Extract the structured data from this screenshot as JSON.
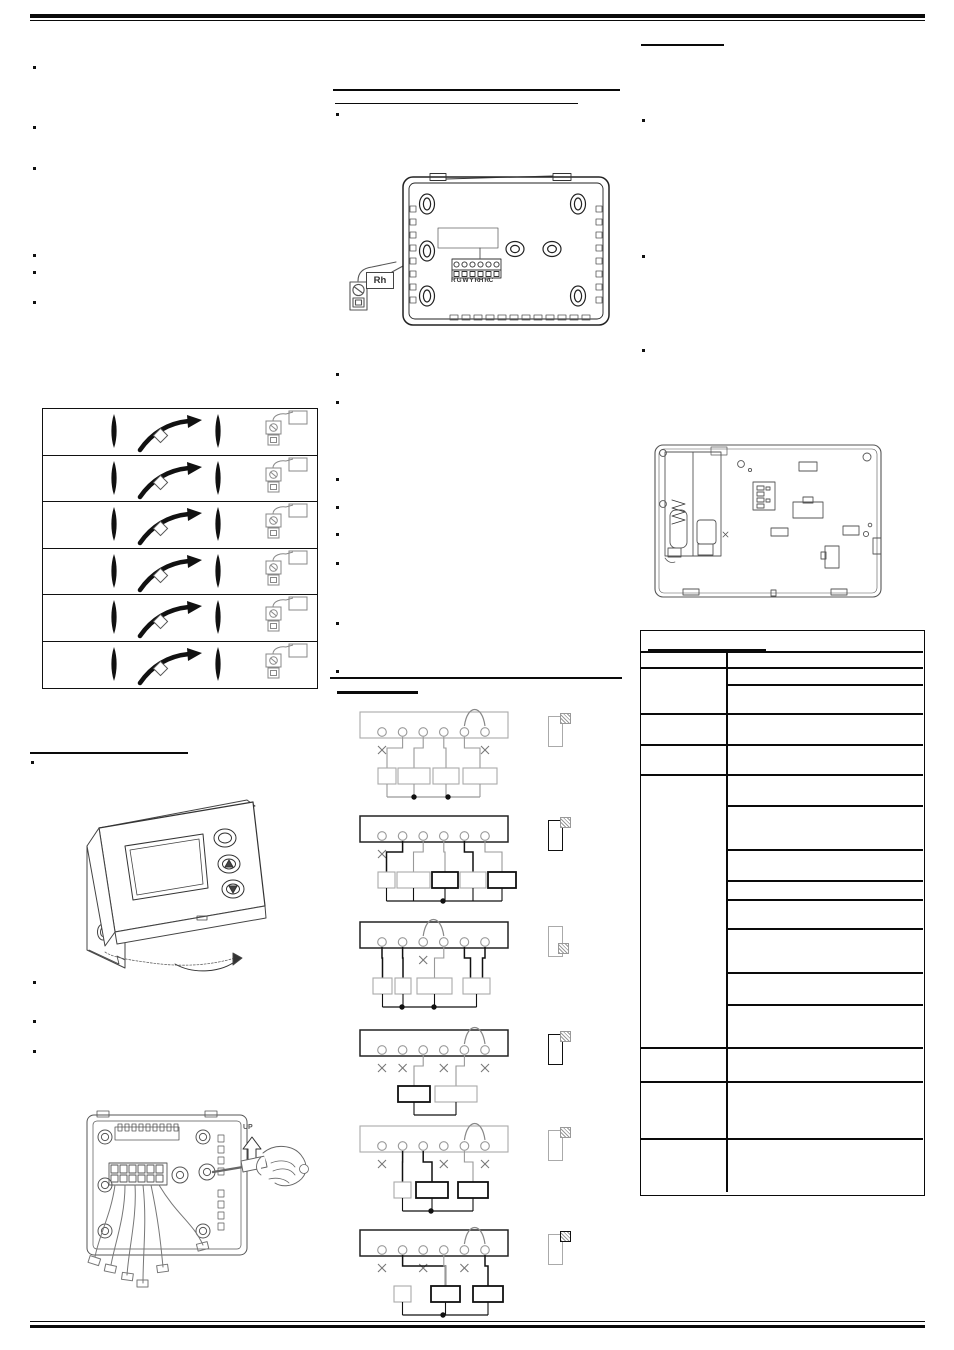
{
  "page": {
    "background": "#ffffff",
    "ink": "#1a1a1a",
    "gray": "#9a9a9a"
  },
  "labels": {
    "rh_terminal": "Rh",
    "terminal_row": "R G W Y RH RC",
    "up": "UP"
  },
  "figures": {
    "dip_setting_table": {
      "row_count": 6,
      "row_icons": [
        "toggle-marker",
        "rotate-gesture-arrow",
        "toggle-marker",
        "rh-screw-terminal"
      ]
    },
    "wiring_diagrams": [
      {
        "y": 712,
        "strip": "gray",
        "jumper": [
          5,
          6
        ],
        "crossed": [
          1,
          6
        ],
        "connections": [
          [
            2,
            1,
            "g",
            0
          ],
          [
            3,
            2,
            "g",
            0
          ],
          [
            4,
            3,
            "g",
            0
          ],
          [
            5,
            4,
            "g",
            0
          ]
        ],
        "boxes": [
          {
            "x": 378,
            "w": 18,
            "bold": false
          },
          {
            "x": 398,
            "w": 32,
            "bold": false
          },
          {
            "x": 433,
            "w": 26,
            "bold": false
          },
          {
            "x": 463,
            "w": 34,
            "bold": false
          }
        ],
        "dots": [
          414,
          448
        ],
        "bottom": "gray",
        "icon": {
          "bold": false,
          "hatch": "tr",
          "hatch_bold": false
        }
      },
      {
        "y": 816,
        "strip": "black",
        "jumper": null,
        "crossed": [
          1
        ],
        "connections": [
          [
            2,
            1,
            "k",
            0
          ],
          [
            3,
            2,
            "g",
            0
          ],
          [
            4,
            3,
            "g",
            0
          ],
          [
            5,
            4,
            "k",
            0
          ],
          [
            6,
            5,
            "g",
            0
          ]
        ],
        "boxes": [
          {
            "x": 378,
            "w": 17,
            "bold": false
          },
          {
            "x": 397,
            "w": 33,
            "bold": false
          },
          {
            "x": 432,
            "w": 26,
            "bold": true
          },
          {
            "x": 460,
            "w": 26,
            "bold": false
          },
          {
            "x": 488,
            "w": 28,
            "bold": true
          }
        ],
        "dots": [
          443
        ],
        "bottom": "black",
        "icon": {
          "bold": true,
          "hatch": "tr",
          "hatch_bold": false
        }
      },
      {
        "y": 922,
        "strip": "black",
        "jumper": [
          3,
          4
        ],
        "crossed": [
          3
        ],
        "connections": [
          [
            1,
            1,
            "k",
            0
          ],
          [
            2,
            2,
            "k",
            0
          ],
          [
            4,
            3,
            "g",
            0
          ],
          [
            5,
            4,
            "k",
            -6
          ],
          [
            6,
            4,
            "k",
            6
          ]
        ],
        "boxes": [
          {
            "x": 373,
            "w": 19,
            "bold": false
          },
          {
            "x": 395,
            "w": 16,
            "bold": false
          },
          {
            "x": 417,
            "w": 35,
            "bold": false
          },
          {
            "x": 463,
            "w": 27,
            "bold": false
          }
        ],
        "dots": [
          402,
          434
        ],
        "bottom": "black",
        "icon": {
          "bold": false,
          "hatch": "br",
          "hatch_bold": false
        }
      },
      {
        "y": 1030,
        "strip": "black",
        "jumper": [
          5,
          6
        ],
        "crossed": [
          1,
          2,
          4,
          6
        ],
        "connections": [
          [
            3,
            1,
            "g",
            0
          ],
          [
            5,
            2,
            "g",
            0
          ]
        ],
        "boxes": [
          {
            "x": 398,
            "w": 32,
            "bold": true
          },
          {
            "x": 435,
            "w": 42,
            "bold": false
          }
        ],
        "dots": [],
        "bottom": "black",
        "icon": {
          "bold": true,
          "hatch": "tr",
          "hatch_bold": false
        }
      },
      {
        "y": 1126,
        "strip": "gray",
        "jumper": [
          5,
          6
        ],
        "crossed": [
          1,
          4,
          6
        ],
        "connections": [
          [
            2,
            1,
            "k",
            0
          ],
          [
            3,
            2,
            "k",
            0
          ],
          [
            5,
            3,
            "g",
            0
          ]
        ],
        "boxes": [
          {
            "x": 394,
            "w": 17,
            "bold": false
          },
          {
            "x": 416,
            "w": 32,
            "bold": true
          },
          {
            "x": 458,
            "w": 30,
            "bold": true
          }
        ],
        "dots": [
          431
        ],
        "bottom": "black",
        "icon": {
          "bold": false,
          "hatch": "tr",
          "hatch_bold": false
        }
      },
      {
        "y": 1230,
        "strip": "black",
        "jumper": [
          5,
          6
        ],
        "crossed": [
          1,
          3,
          5
        ],
        "connections": [
          [
            2,
            2,
            "k",
            0
          ],
          [
            4,
            2,
            "g",
            0
          ],
          [
            6,
            3,
            "k",
            0
          ]
        ],
        "boxes": [
          {
            "x": 394,
            "w": 17,
            "bold": false
          },
          {
            "x": 431,
            "w": 29,
            "bold": true
          },
          {
            "x": 473,
            "w": 30,
            "bold": true
          }
        ],
        "dots": [
          443
        ],
        "bottom": "black",
        "icon": {
          "bold": false,
          "hatch": "tr",
          "hatch_bold": true
        }
      }
    ],
    "right_table": {
      "left_column_rows": 8,
      "right_column_rows": 16
    }
  }
}
